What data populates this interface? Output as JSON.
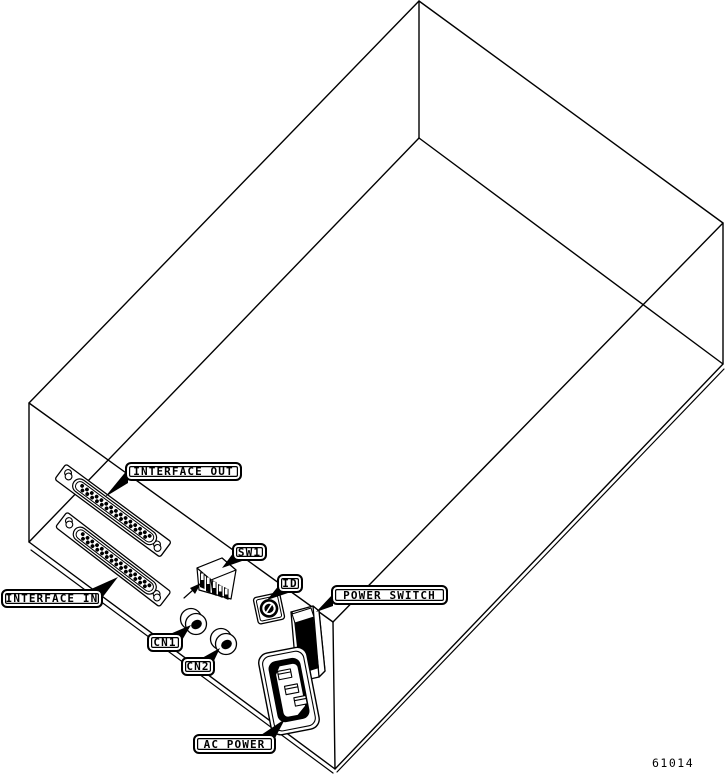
{
  "figure": {
    "type": "isometric-rear-panel-diagram",
    "number": "61014",
    "colors": {
      "line": "#000000",
      "background": "#ffffff"
    },
    "callouts": {
      "interface_out": "INTERFACE OUT",
      "interface_in": "INTERFACE IN",
      "sw1": "SW1",
      "id": "ID",
      "power_switch": "POWER SWITCH",
      "cn1": "CN1",
      "cn2": "CN2",
      "ac_power": "AC POWER"
    },
    "components": [
      "interface-out-dsub-connector",
      "interface-in-dsub-connector",
      "sw1-dip-switch",
      "id-rotary-switch",
      "cn1-round-jack",
      "cn2-round-jack",
      "power-rocker-switch",
      "ac-power-inlet"
    ]
  }
}
